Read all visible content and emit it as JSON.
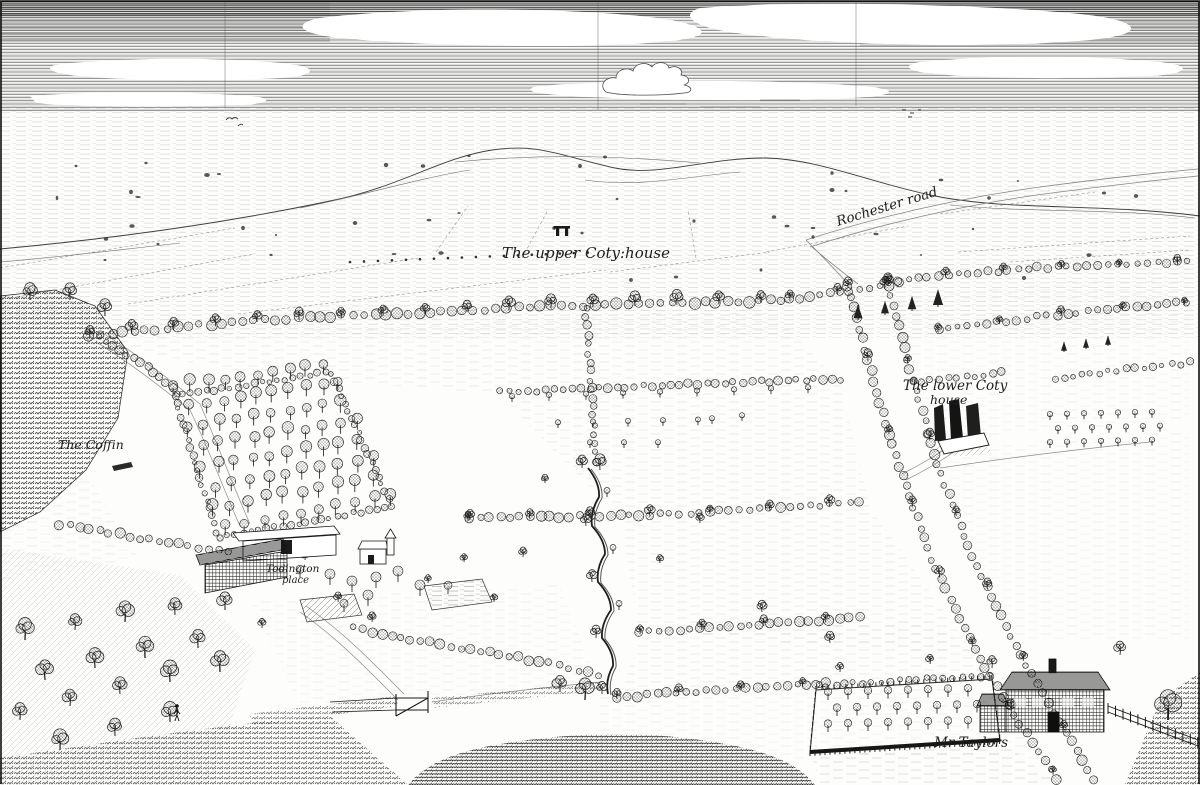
{
  "scene": {
    "kind": "engraved-landscape-prospect",
    "ink_color": "#1b1b1b",
    "paper_color": "#fdfdfb"
  },
  "labels": {
    "upper_coty": "The upper Coty:house",
    "rochester_road": "Rochester road",
    "lower_coty_line1": "The lower Coty",
    "lower_coty_line2": "house",
    "the_coffin": "The Coffin",
    "todington_line1": "Todington",
    "todington_line2": "place",
    "mr_taylors": "Mr Taylors"
  }
}
